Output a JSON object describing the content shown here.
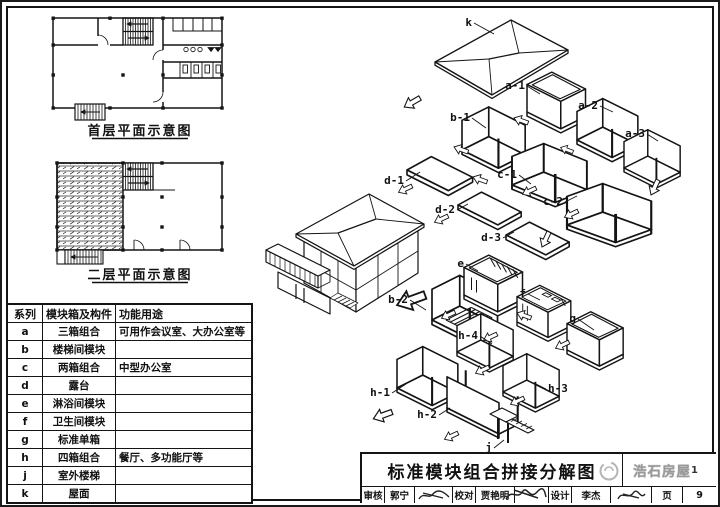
{
  "plans": {
    "first_floor_title": "首层平面示意图",
    "second_floor_title": "二层平面示意图"
  },
  "module_table": {
    "headers": {
      "series": "系列",
      "module": "模块箱及构件",
      "function": "功能用途"
    },
    "rows": [
      {
        "series": "a",
        "module": "三箱组合",
        "function": "可用作会议室、大办公室等"
      },
      {
        "series": "b",
        "module": "楼梯间模块",
        "function": ""
      },
      {
        "series": "c",
        "module": "两箱组合",
        "function": "中型办公室"
      },
      {
        "series": "d",
        "module": "露台",
        "function": ""
      },
      {
        "series": "e",
        "module": "淋浴间模块",
        "function": ""
      },
      {
        "series": "f",
        "module": "卫生间模块",
        "function": ""
      },
      {
        "series": "g",
        "module": "标准单箱",
        "function": ""
      },
      {
        "series": "h",
        "module": "四箱组合",
        "function": "餐厅、多功能厅等"
      },
      {
        "series": "j",
        "module": "室外楼梯",
        "function": ""
      },
      {
        "series": "k",
        "module": "屋面",
        "function": ""
      }
    ]
  },
  "diagram": {
    "labels": {
      "k": "k",
      "a-1": "a-1",
      "a-2": "a-2",
      "a-3": "a-3",
      "b-1": "b-1",
      "b-2": "b-2",
      "c-1": "c-1",
      "c-2": "c-2",
      "d-1": "d-1",
      "d-2": "d-2",
      "d-3": "d-3",
      "e": "e",
      "f": "f",
      "g": "g",
      "h-1": "h-1",
      "h-2": "h-2",
      "h-3": "h-3",
      "h-4": "h-4",
      "j": "j"
    }
  },
  "title_block": {
    "drawing_title": "标准模块组合拼接分解图",
    "fields": [
      {
        "label": "审核",
        "value": "郭宁"
      },
      {
        "label": "校对",
        "value": "贾艳明"
      },
      {
        "label": "设计",
        "value": "李杰"
      }
    ],
    "page_label": "页",
    "page_number": "9",
    "watermark_text": "浩石房屋",
    "watermark_suffix": "1"
  },
  "colors": {
    "line": "#141414",
    "watermark": "#9a9a9a"
  }
}
